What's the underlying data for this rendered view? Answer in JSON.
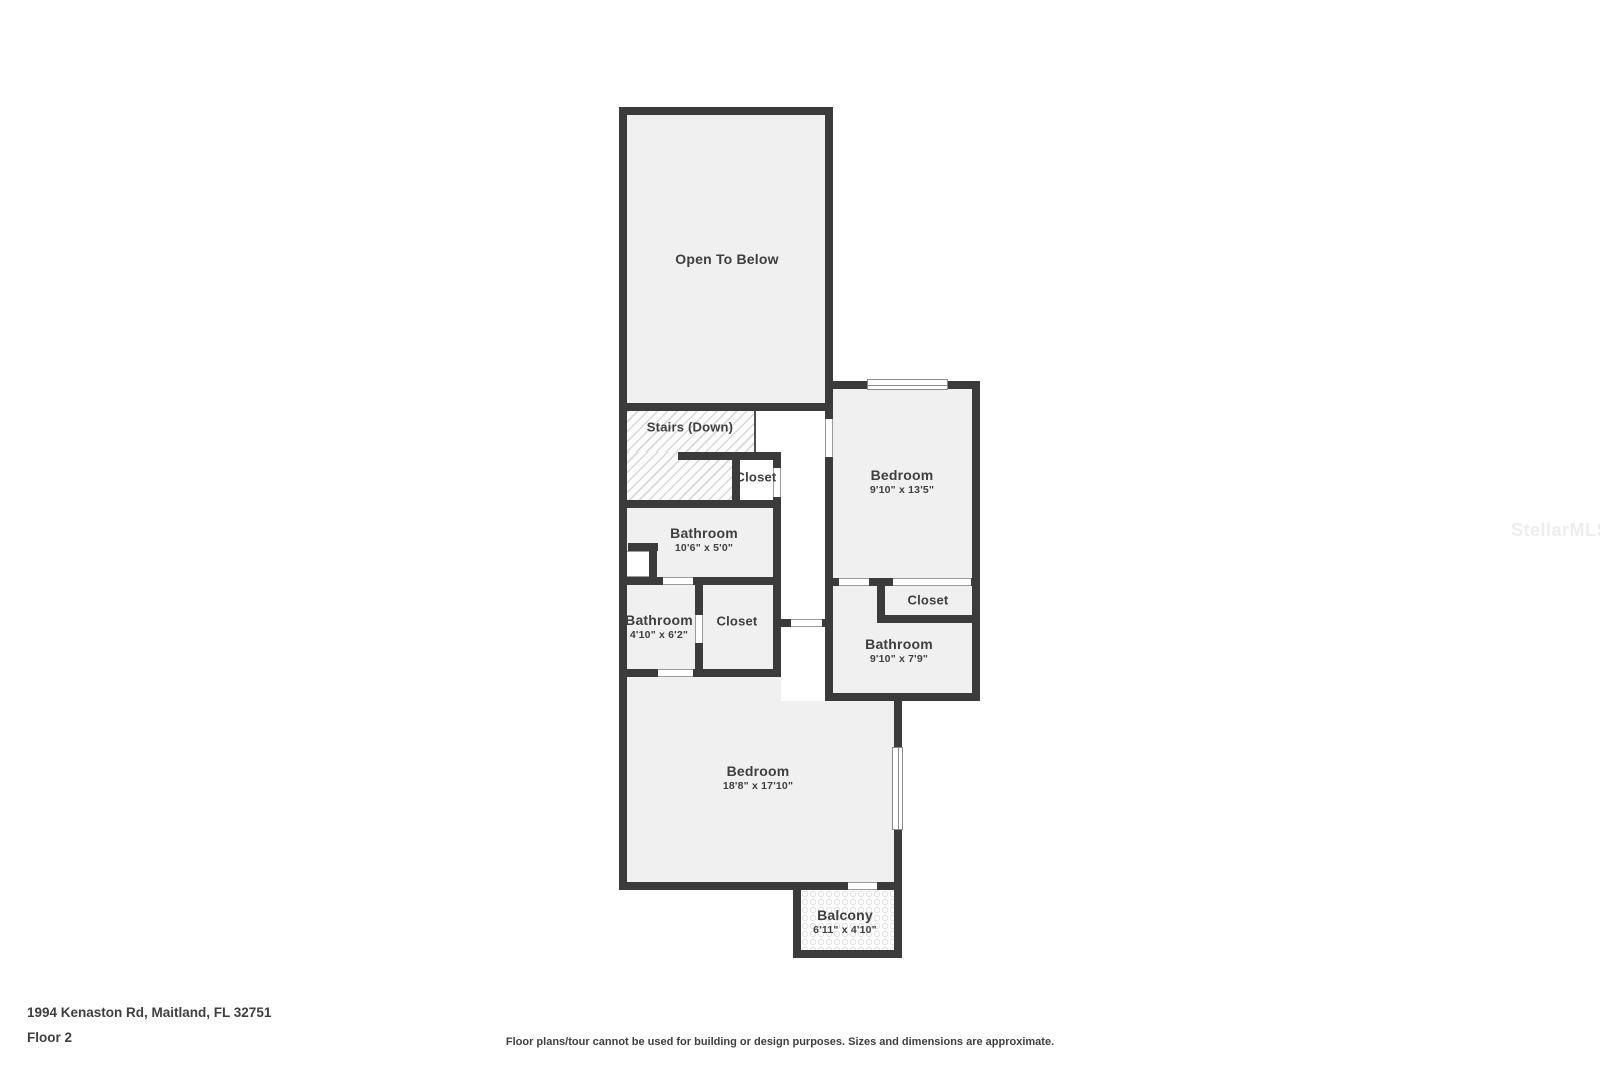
{
  "title": "Floor 2 floor plan",
  "colors": {
    "wall": "#3b3b3b",
    "room_fill": "#f0f0f0",
    "text": "#3f3f3f",
    "watermark": "#ededed",
    "hatch_line": "#d9d9d9"
  },
  "watermark": {
    "text": "StellarMLS"
  },
  "footer": {
    "address": "1994 Kenaston Rd, Maitland, FL 32751",
    "floor_label": "Floor 2",
    "disclaimer": "Floor plans/tour cannot be used for building or design purposes. Sizes and dimensions are approximate."
  },
  "rooms": [
    {
      "name": "Open To Below",
      "dims": ""
    },
    {
      "name": "Stairs (Down)",
      "dims": ""
    },
    {
      "name": "Closet",
      "dims": ""
    },
    {
      "name": "Bedroom",
      "dims": "9'10\" x 13'5\""
    },
    {
      "name": "Bathroom",
      "dims": "10'6\" x 5'0\""
    },
    {
      "name": "Bathroom",
      "dims": "4'10\" x 6'2\""
    },
    {
      "name": "Closet",
      "dims": ""
    },
    {
      "name": "Closet",
      "dims": ""
    },
    {
      "name": "Bathroom",
      "dims": "9'10\" x 7'9\""
    },
    {
      "name": "Bedroom",
      "dims": "18'8\" x 17'10\""
    },
    {
      "name": "Balcony",
      "dims": "6'11\" x 4'10\""
    }
  ]
}
